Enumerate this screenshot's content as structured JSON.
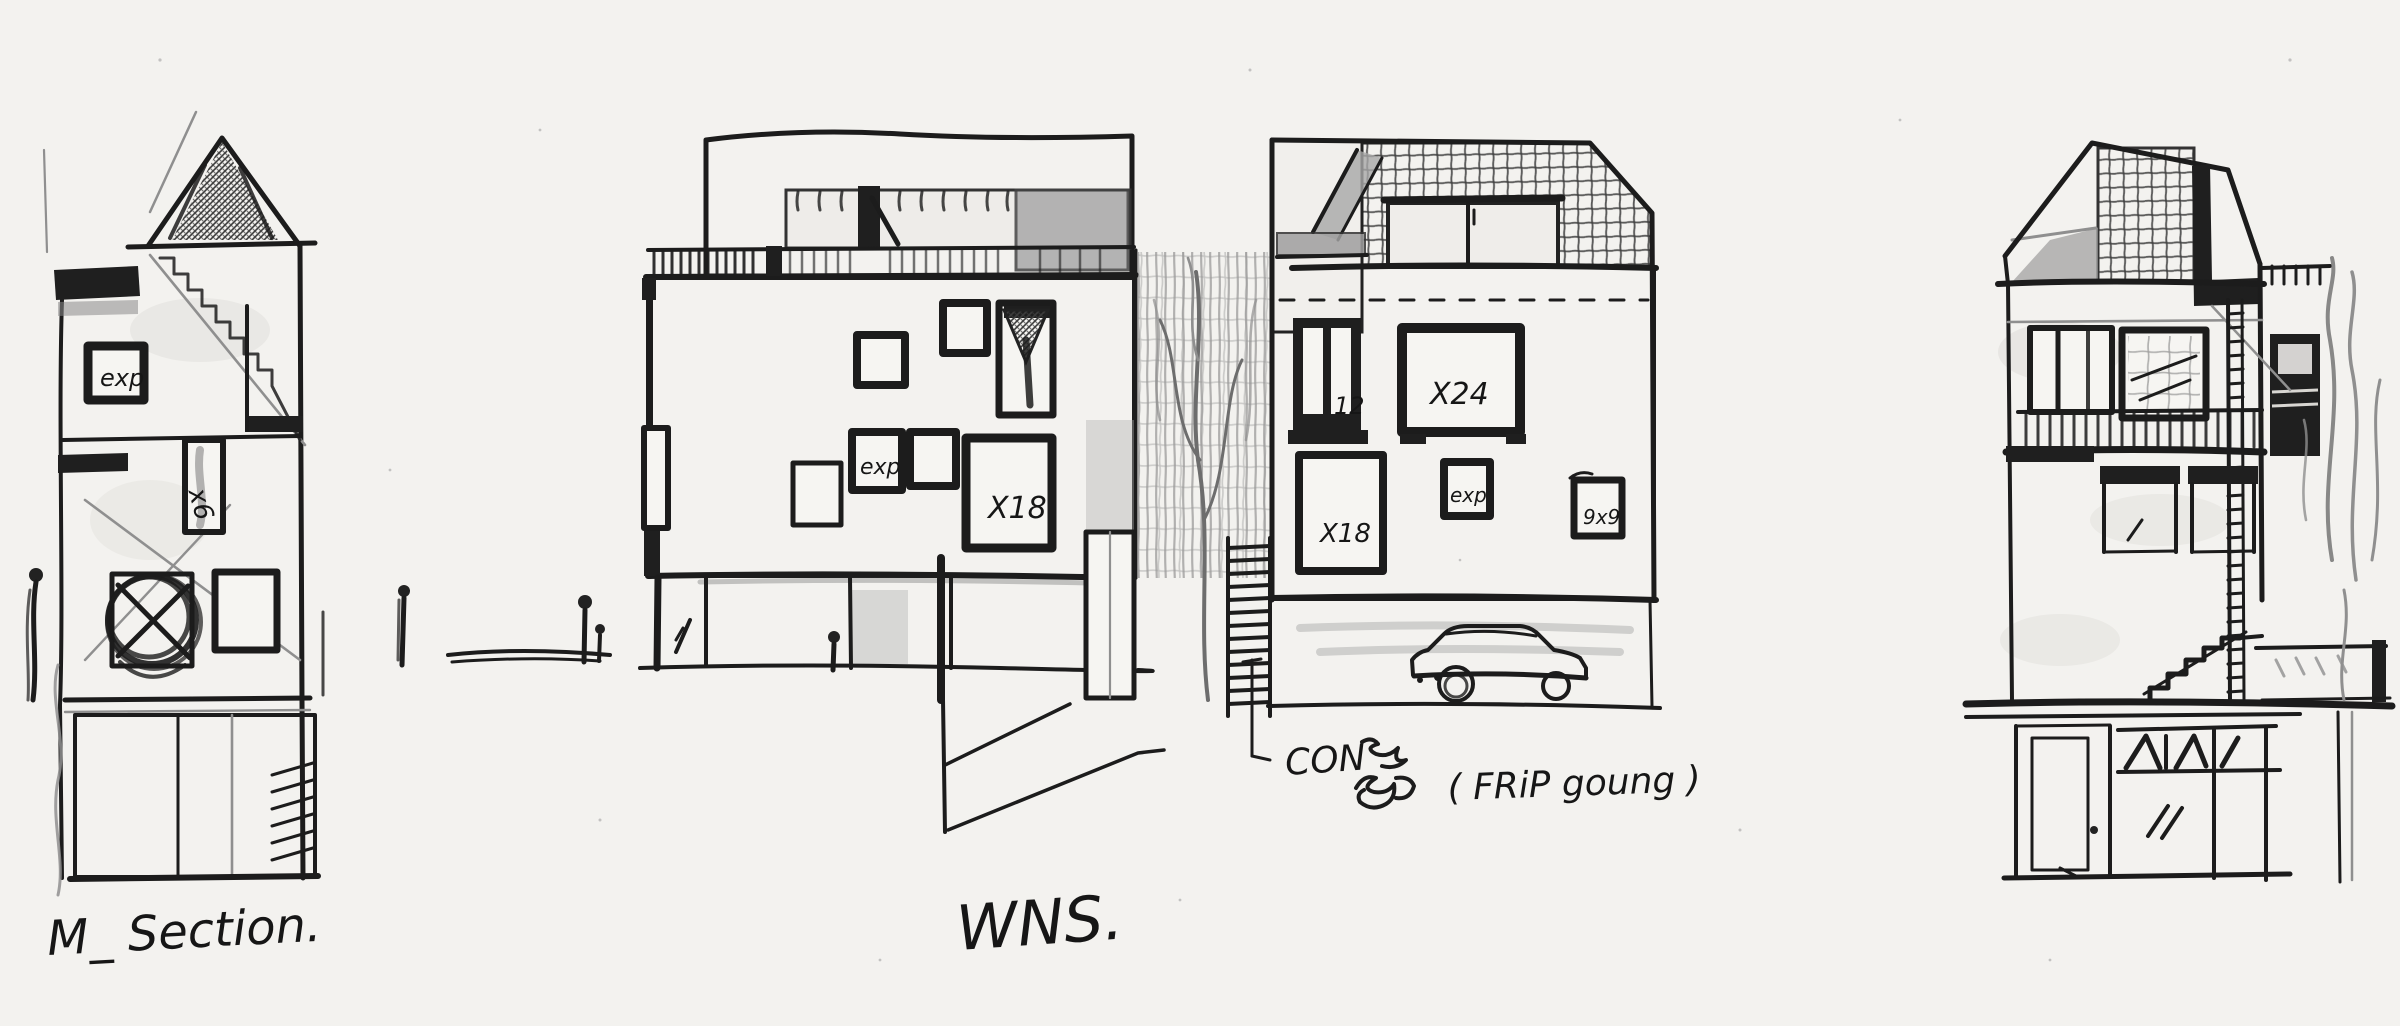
{
  "titles": {
    "left": "M_ Section.",
    "center": "WNS."
  },
  "annotation": {
    "prefix": "CON",
    "suffix": "( FRiP goung )"
  },
  "labels": {
    "left_window": "exp",
    "left_shaft": "x6",
    "cl_small_window": "exp",
    "cl_big_window": "X18",
    "cr_dark_window": "12",
    "cr_wide_window": "X24",
    "cr_big_window": "X18",
    "cr_small_window": "exp",
    "cr_tiny_window": "9x9"
  },
  "colors": {
    "paper": "#f3f2ef",
    "ink": "#1c1c1c",
    "pencil": "#8f8f8f",
    "marker": "#a8a8a8"
  }
}
